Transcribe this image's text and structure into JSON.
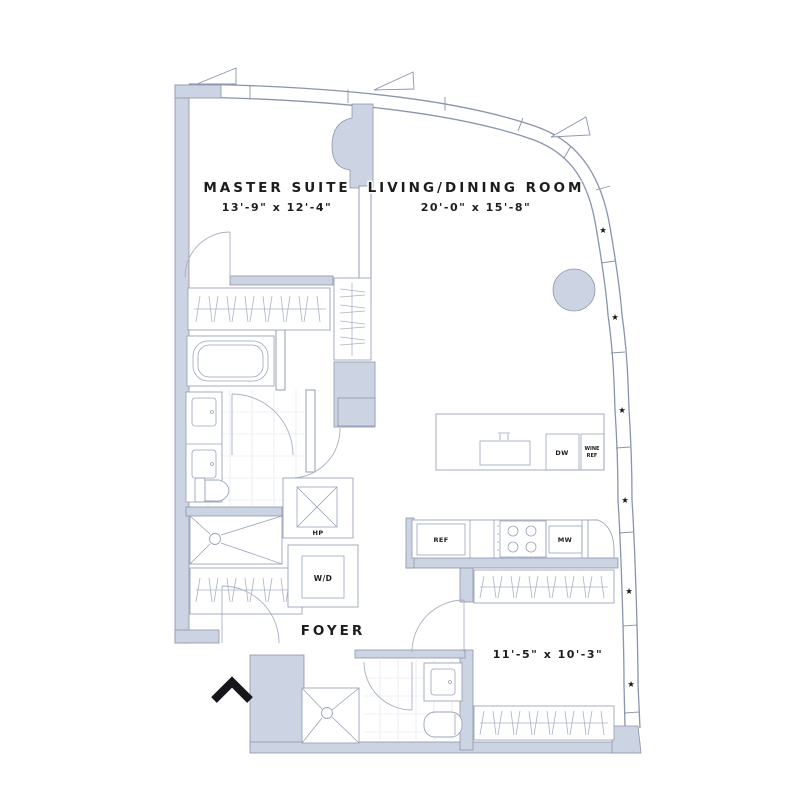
{
  "floor_plan": {
    "rooms": {
      "master_suite": {
        "name": "MASTER SUITE",
        "dimensions": "13'-9\" x 12'-4\""
      },
      "living_dining": {
        "name": "LIVING/DINING ROOM",
        "dimensions": "20'-0\" x 15'-8\""
      },
      "foyer": {
        "name": "FOYER"
      },
      "second_bedroom": {
        "dimensions": "11'-5\" x 10'-3\""
      }
    },
    "labels": {
      "heat_pump": "HP",
      "washer_dryer": "W/D",
      "dishwasher": "DW",
      "wine_ref_line1": "WINE",
      "wine_ref_line2": "REF",
      "refrigerator": "REF",
      "microwave": "MW"
    },
    "icons": {
      "window_marker": "★",
      "north_arrow": "chevron-up"
    },
    "colors": {
      "wall_fill": "#ccd3e3",
      "wall_stroke": "#8a94ab",
      "fixture_line": "#9aa3b8",
      "tile_line": "#dde1ea",
      "text": "#1d1d1f",
      "background": "#ffffff"
    }
  }
}
